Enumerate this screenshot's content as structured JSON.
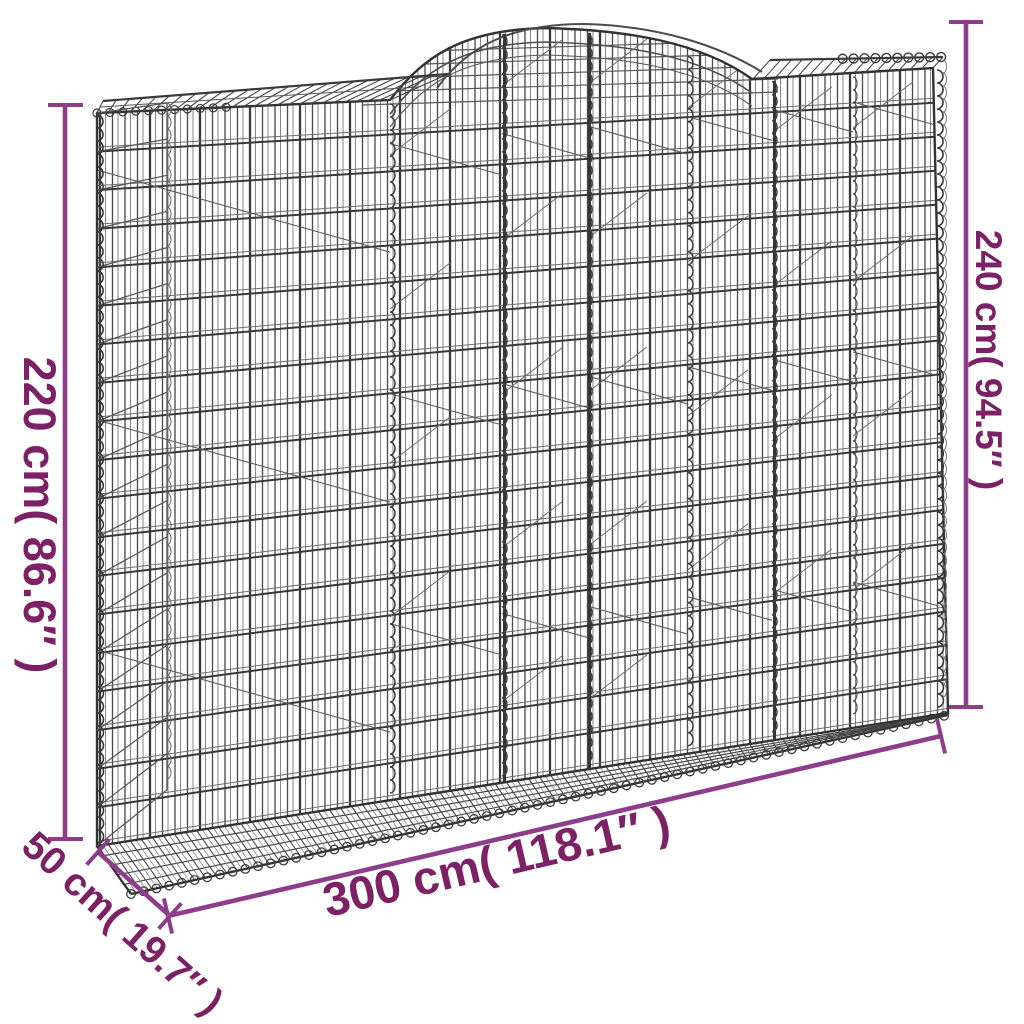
{
  "image": {
    "alt": "Arched gabion basket wireframe dimension diagram",
    "background": "#ffffff"
  },
  "colors": {
    "dimension_line": "#8e3d8a",
    "dimension_text": "#7c2165",
    "wire_dark": "#383838",
    "wire_mid": "#4c4c4c",
    "wire_light": "#7a7a7a",
    "wire_back": "#6e6e6e"
  },
  "dimensions": {
    "height_left": {
      "label": "220 cm( 86.6″ )",
      "cm": 220,
      "inches": 86.6,
      "side": "left"
    },
    "height_right": {
      "label": "240 cm( 94.5″ )",
      "cm": 240,
      "inches": 94.5,
      "side": "right"
    },
    "width": {
      "label": "300 cm( 118.1″ )",
      "cm": 300,
      "inches": 118.1,
      "side": "bottom"
    },
    "depth": {
      "label": "50 cm( 19.7″ )",
      "cm": 50,
      "inches": 19.7,
      "side": "bottom-left"
    }
  }
}
